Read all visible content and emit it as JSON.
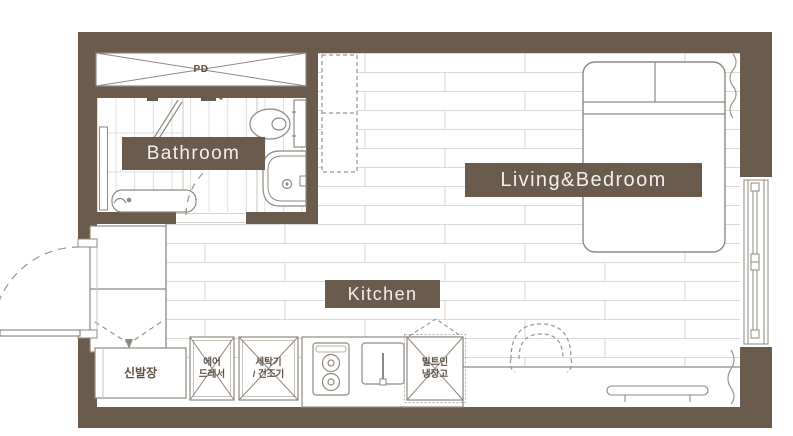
{
  "colors": {
    "wall": "#6B5B4D",
    "badge_background": "#6B5B4D",
    "badge_text": "#F3F0EC",
    "fixture_line": "#8F8880",
    "floor_line": "#DBD7D1",
    "korean_text": "#5F5044"
  },
  "rooms": {
    "bathroom": {
      "label": "Bathroom"
    },
    "living_bedroom": {
      "label": "Living&Bedroom"
    },
    "kitchen": {
      "label": "Kitchen"
    }
  },
  "annotations": {
    "pipe_duct": "PD",
    "shoe_cabinet": "신발장",
    "air_dresser": {
      "line1": "에어",
      "line2": "드레서"
    },
    "washer_dryer": {
      "line1": "세탁기",
      "line2": "/ 건조기"
    },
    "built_in_fridge": {
      "line1": "빌트인",
      "line2": "냉장고"
    }
  },
  "symbols": [
    "pd-duct",
    "ceiling-unit",
    "shower-screen",
    "shower-head",
    "toilet",
    "washbasin",
    "bath-bench",
    "bathroom-door-swing",
    "entrance-door-swing",
    "entry-closet",
    "shoe-cabinet",
    "air-dresser-box",
    "washer-dryer-box",
    "built-in-fridge-box",
    "cooktop",
    "kitchen-sink",
    "chair",
    "desk-shelf",
    "bed",
    "window",
    "curtain"
  ]
}
